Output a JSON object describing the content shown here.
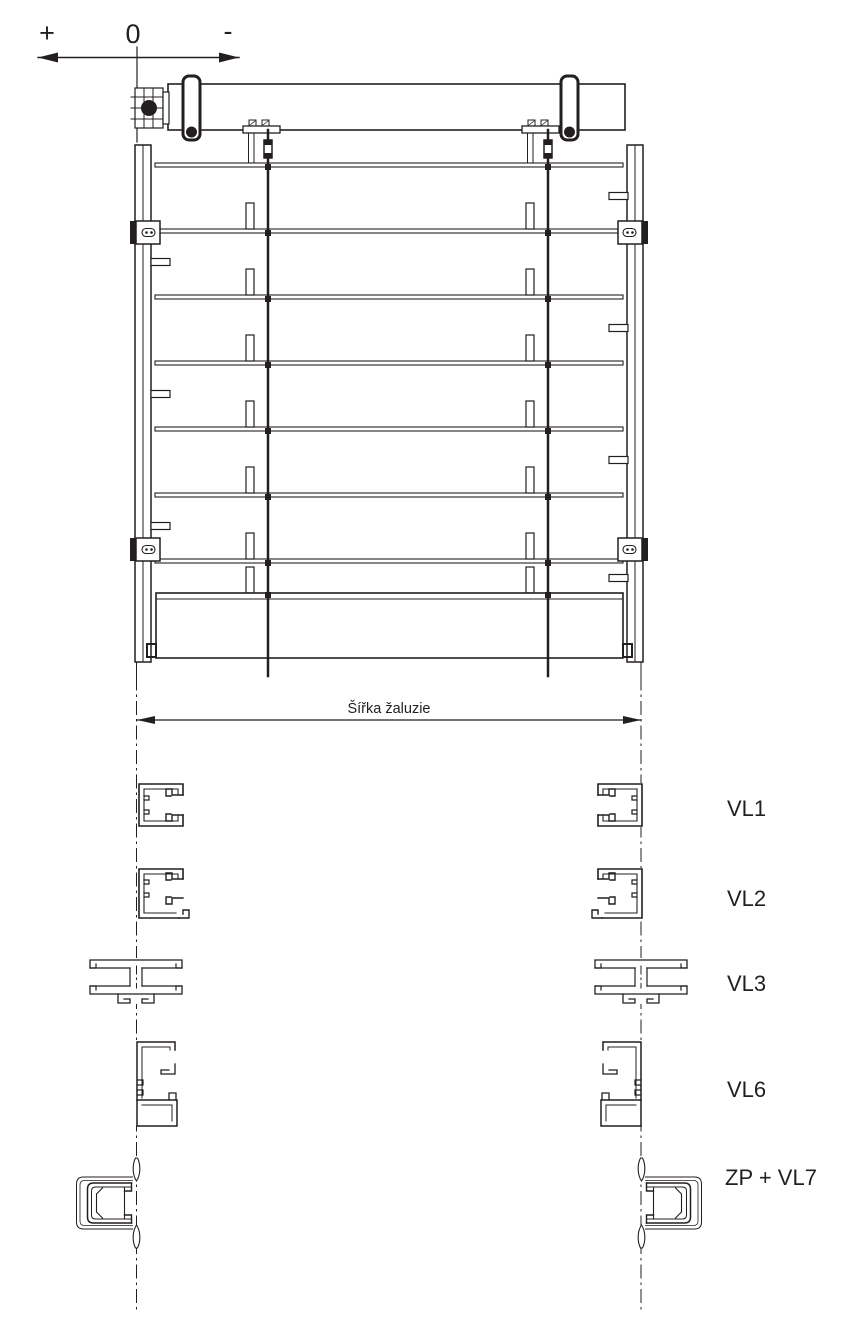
{
  "diagram": {
    "type": "technical-drawing",
    "subject": "external-venetian-blind-front-view-with-guide-rail-sections",
    "axis": {
      "plus_label": "+",
      "zero_label": "0",
      "minus_label": "-"
    },
    "dimension": {
      "label": "Šířka žaluzie"
    },
    "profiles": [
      {
        "label": "VL1"
      },
      {
        "label": "VL2"
      },
      {
        "label": "VL3"
      },
      {
        "label": "VL6"
      },
      {
        "label": "ZP + VL7"
      }
    ],
    "colors": {
      "line": "#231f20",
      "background": "#ffffff"
    }
  }
}
